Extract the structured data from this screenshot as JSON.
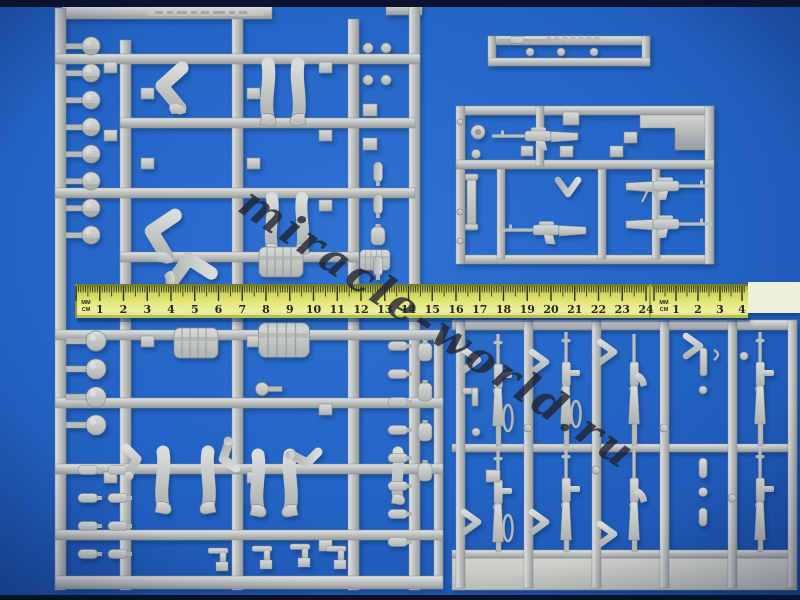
{
  "scene": {
    "type": "photograph",
    "background_color": "#2363c3",
    "plastic_color": "#bfc2c1",
    "sprues": [
      {
        "name": "figures-sprue",
        "contents": "soldier figure parts: helmets, heads, torsos, legs, arms, backpacks, small equipment"
      },
      {
        "name": "sling-rifle-sprue",
        "contents": "single rifle with coiled sling on a narrow runner"
      },
      {
        "name": "weapons-sprue",
        "contents": "rifles, machine guns, periscope and accessories in a rectangular runner"
      },
      {
        "name": "rifle-rack-sprue",
        "contents": "columns of vertical rifles and carbines with chevrons"
      }
    ]
  },
  "watermark": {
    "text": "miracle-world.ru",
    "color": "#23242c"
  },
  "ruler": {
    "tape_color": "#dfe36c",
    "segments": [
      {
        "unit_top": "MM",
        "unit_bottom": "CM",
        "numbers": [
          1,
          2,
          3,
          4,
          5,
          6,
          7,
          8,
          9,
          10,
          11,
          12,
          13,
          14,
          15,
          16,
          17,
          18,
          19,
          20,
          21,
          22,
          23,
          24
        ]
      },
      {
        "unit_top": "MM",
        "unit_bottom": "CM",
        "numbers": [
          1,
          2,
          3,
          4
        ]
      }
    ]
  }
}
